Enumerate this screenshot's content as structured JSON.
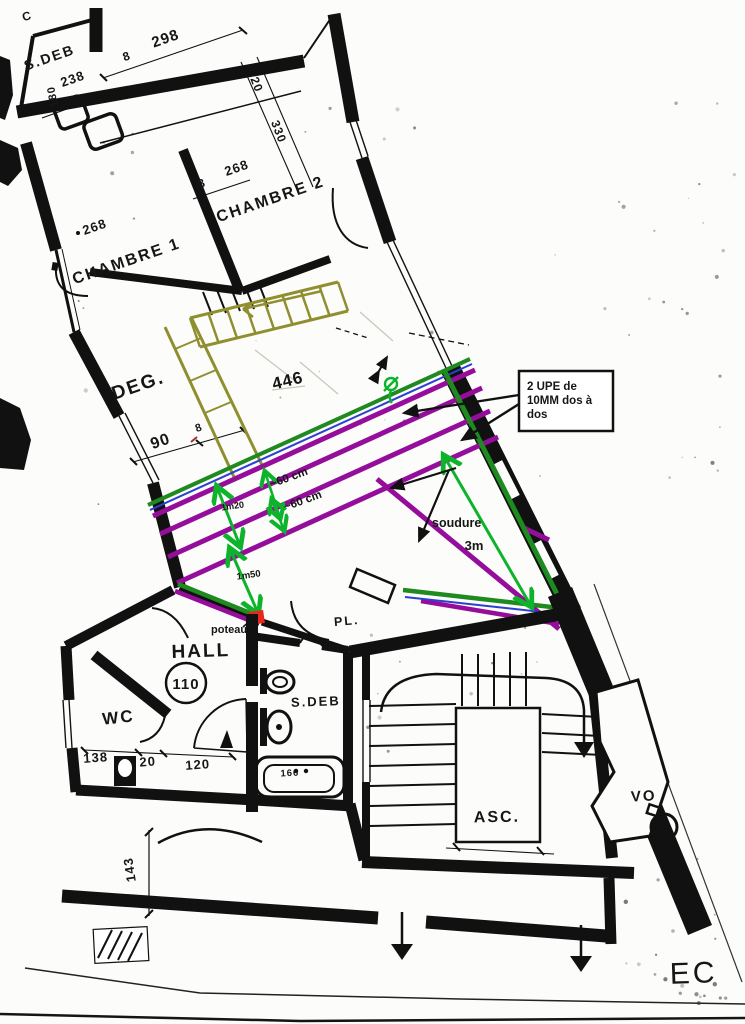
{
  "rooms": {
    "sdeb_top": "S.DEB",
    "chambre1": "CHAMBRE 1",
    "chambre2": "CHAMBRE 2",
    "deg": "DEG.",
    "hall": "HALL",
    "hall_number": "110",
    "wc": "WC",
    "sdeb_lower": "S.DEB",
    "pl": "PL.",
    "asc": "ASC.",
    "vo": "VO",
    "ec": "EC"
  },
  "dimensions": {
    "corner_mark": "C",
    "d298": "298",
    "d8_top": "8",
    "d238": "238",
    "d180": "180",
    "d20_corridor": "20",
    "d330": "330",
    "d8_ch2": "8",
    "d268_ch2": "268",
    "d268_ch1": "268",
    "d90": "90",
    "d8_deg": "8",
    "d446": "446",
    "d138": "138",
    "d20_wc": "20",
    "d120": "120",
    "d166": "166",
    "d143": "143"
  },
  "annotations": {
    "upe_box_line1": "2 UPE de",
    "upe_box_line2": "10MM dos à",
    "upe_box_line3": "dos",
    "soudure": "soudure",
    "poteau": "poteau",
    "dim60_a": "~60 cm",
    "dim60_b": "~60 cm",
    "dim1m20": "1m20",
    "dim1m50": "1m50",
    "dim3m": "3m"
  },
  "colors": {
    "beam_purple": "#950d9b",
    "arrow_green": "#0db32b",
    "wall_green": "#1f8a1f",
    "stair_olive": "#8f8f2f",
    "line_blue": "#2b3fd4",
    "post_red": "#e6261f",
    "wall_black": "#111111"
  }
}
